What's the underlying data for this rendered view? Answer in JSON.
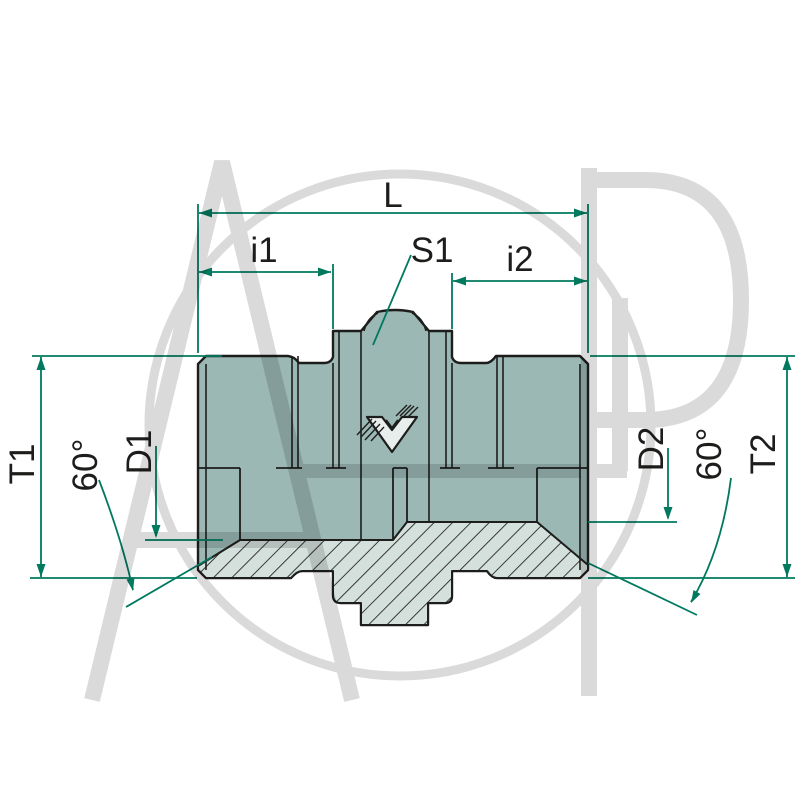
{
  "drawing": {
    "subject": "Hydraulic straight male-male adapter fitting, half-section technical drawing",
    "labels": {
      "overall_length": "L",
      "thread_length_left": "i1",
      "hex_wrench_size": "S1",
      "thread_length_right": "i2",
      "thread_size_left": "T1",
      "cone_angle_left": "60°",
      "seal_cone_diameter_left": "D1",
      "seal_cone_diameter_right": "D2",
      "cone_angle_right": "60°",
      "thread_size_right": "T2"
    },
    "watermark_text": "AGP",
    "colors": {
      "dimension_lines": "#00795f",
      "body_fill": "#9bb8b4",
      "section_fill": "#d4e0dc",
      "outline": "#1d1d1b",
      "watermark": "#c3c3c3",
      "background": "#ffffff"
    }
  }
}
